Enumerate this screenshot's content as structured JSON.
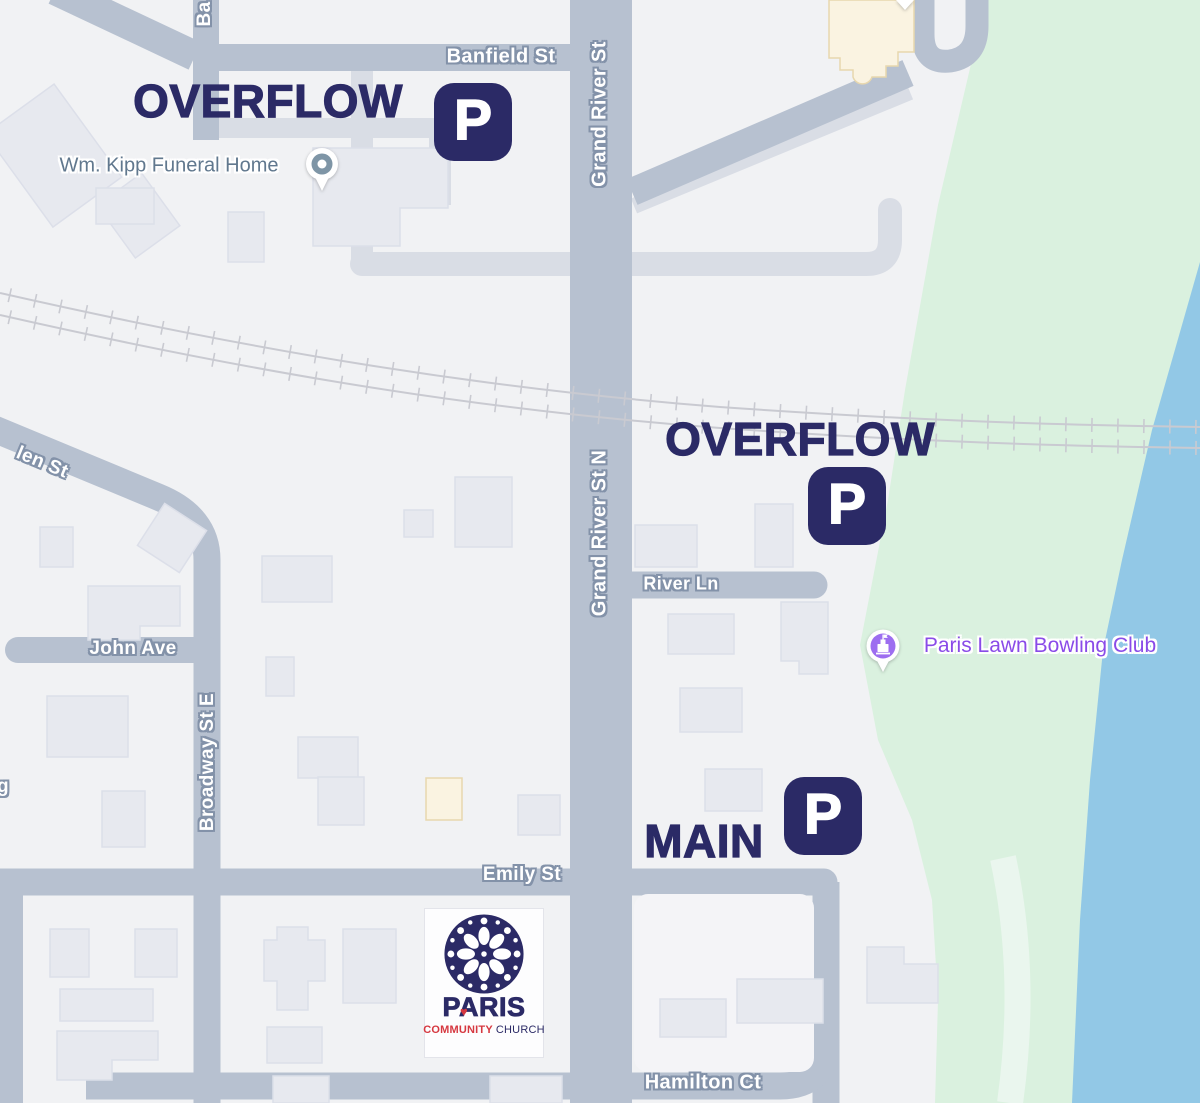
{
  "map": {
    "streets": {
      "banfield": "Banfield St",
      "ba_partial": "Ba",
      "grand_river": "Grand River St",
      "grand_river_n": "Grand River St N",
      "len_partial": "len St",
      "river_ln": "River Ln",
      "john": "John Ave",
      "broadway": "Broadway St E",
      "emily": "Emily St",
      "hamilton": "Hamilton Ct",
      "g_partial": "g"
    },
    "pois": {
      "funeral_home": {
        "label": "Wm. Kipp Funeral Home"
      },
      "bowling_club": {
        "label": "Paris Lawn Bowling Club"
      }
    },
    "annotations": {
      "overflow_top": "OVERFLOW",
      "overflow_mid": "OVERFLOW",
      "main": "MAIN",
      "parking_letter": "P"
    },
    "logo": {
      "title": "PARIS",
      "heart": "♥",
      "subtitle_left": "COMMUNITY",
      "subtitle_right": "CHURCH"
    },
    "colors": {
      "annotation_navy": "#2b2a66",
      "poi_purple": "#8a4be8",
      "pin_purple": "#9d6ef0",
      "poi_gray": "#61788e",
      "road": "#b7c1d0",
      "road_light": "#d9dde5",
      "park": "#daf1df",
      "water": "#92c8e6",
      "building": "#e7e9ef",
      "cream": "#faf3e1",
      "rail": "#c9cad1",
      "label_halo": "#8392a9",
      "logo_red": "#d63840",
      "bg": "#f1f2f4"
    }
  }
}
